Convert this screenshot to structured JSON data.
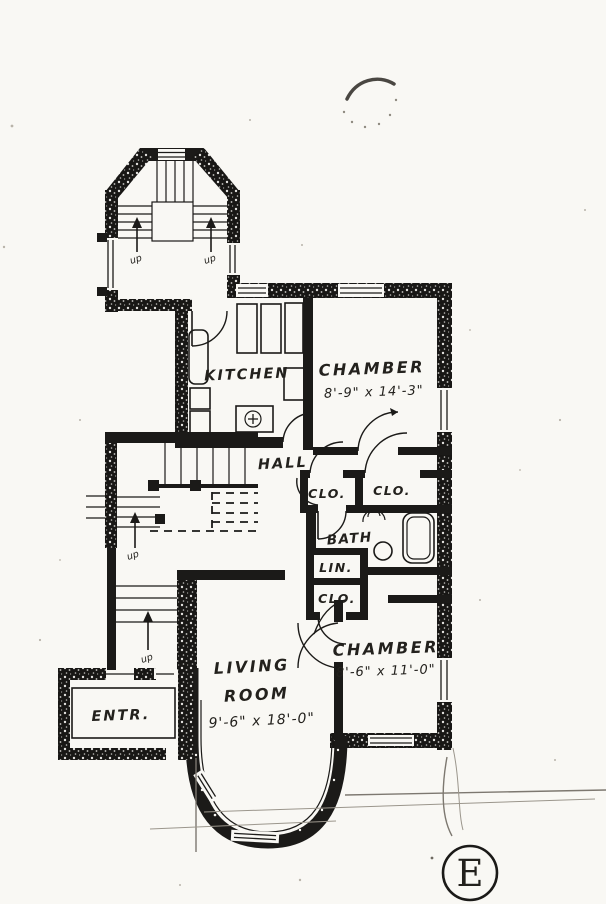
{
  "document": {
    "kind": "scanned hand-drawn apartment floor plan",
    "sheet_mark": "E"
  },
  "labels": {
    "kitchen": "KITCHEN",
    "chamber_top": "CHAMBER",
    "chamber_top_dims": "8'-9\" x 14'-3\"",
    "hall": "HALL",
    "closet_a": "CLO.",
    "closet_b": "CLO.",
    "bath": "BATH",
    "linen": "LIN.",
    "closet_c": "CLO.",
    "chamber_bottom": "CHAMBER",
    "chamber_bottom_dims": "8'-6\" x 11'-0\"",
    "living_line1": "LIVING",
    "living_line2": "ROOM",
    "living_dims": "9'-6\" x 18'-0\"",
    "entrance": "ENTR.",
    "stair_up_tower_left": "up",
    "stair_up_tower_right": "up",
    "stair_up_main": "up",
    "stair_up_front": "up"
  }
}
